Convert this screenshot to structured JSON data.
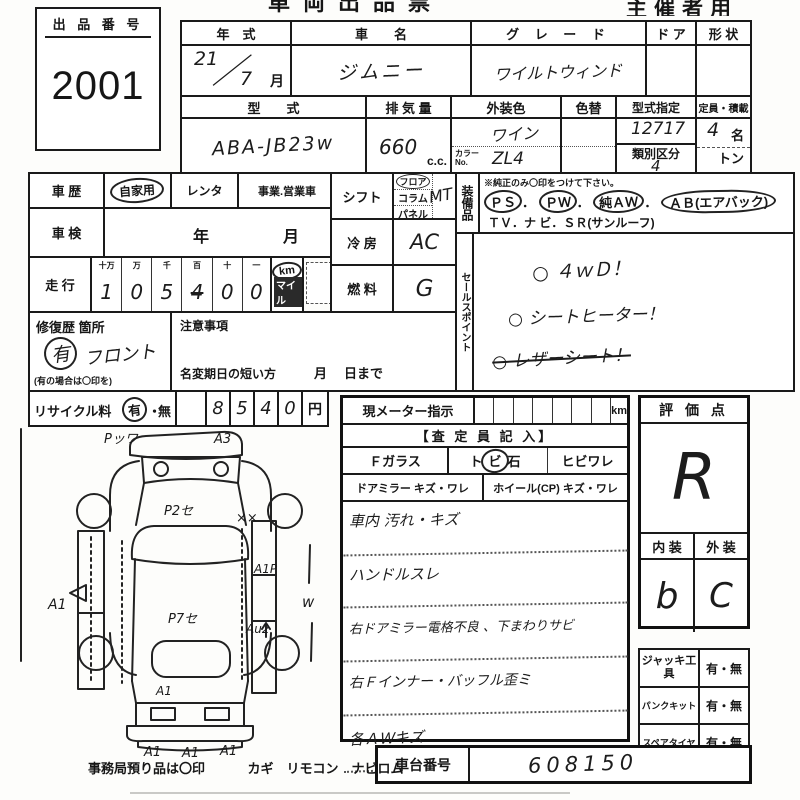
{
  "header": {
    "title_fragment": "車両出品票",
    "organizer": "主催者用"
  },
  "lot": {
    "label": "出 品 番 号",
    "number": "2001"
  },
  "top_table": {
    "year_label": "年　式",
    "year_top": "21",
    "year_slash": "／",
    "year_bottom": "7",
    "month_label": "月",
    "name_label": "車　　名",
    "name_value": "ジムニー",
    "grade_label": "グ レ ー ド",
    "grade_value": "ワイルトウィンド",
    "door_label": "ド ア",
    "shape_label": "形 状",
    "model_label": "型　　式",
    "model_value": "ABA-JB23w",
    "disp_label": "排 気 量",
    "disp_value": "660",
    "disp_unit": "c.c.",
    "extcolor_label": "外装色",
    "extcolor_value": "ワイン",
    "colorno_label": "カラーNo.",
    "colorno_value": "ZL4",
    "colorchg_label": "色替",
    "typedesig_label": "型式指定",
    "typedesig_value": "12717",
    "class_label": "類別区分",
    "class_value": "4",
    "capacity_label": "定員・積載",
    "capacity_value": "4",
    "capacity_unit": "名",
    "load_unit": "トン"
  },
  "history": {
    "label": "車 歴",
    "opt1": "自家用",
    "opt2": "レンタ",
    "opt3": "事業.営業車"
  },
  "shaken": {
    "label": "車 検",
    "year": "年",
    "month": "月"
  },
  "mileage": {
    "label": "走 行",
    "headers": [
      "十万",
      "万",
      "千",
      "百",
      "十",
      "一"
    ],
    "digits": [
      "1",
      "0",
      "5",
      "4",
      "0",
      "0"
    ],
    "km": "km",
    "mile": "マイル"
  },
  "repair": {
    "label": "修復歴 箇所",
    "mark": "有",
    "value": "フロント",
    "note": "(有の場合は〇印を)"
  },
  "caution": {
    "label": "注意事項",
    "transfer": "名変期日の短い方",
    "m": "月",
    "d": "日まで"
  },
  "recycle": {
    "label": "リサイクル料",
    "yes": "有",
    "sep": "・",
    "no": "無",
    "digits": [
      "8",
      "5",
      "4",
      "0"
    ],
    "unit": "円"
  },
  "shift": {
    "label": "シフト",
    "opt1": "フロア",
    "opt2": "コラム",
    "opt3": "パネル",
    "value": "MT"
  },
  "cooling": {
    "label": "冷 房",
    "value": "AC"
  },
  "fuel": {
    "label": "燃 料",
    "value": "G"
  },
  "equipment": {
    "label": "装備品",
    "note": "※純正のみ〇印をつけて下さい。",
    "ps": "ＰＳ",
    "pw": "ＰＷ",
    "aw": "純ＡＷ",
    "ab": "ＡＢ(エアバック)",
    "sep": "．",
    "line2": "ＴＶ．ナ ビ．ＳＲ(サンルーフ)",
    "line3": "新車保証書←(注) 後日送りのみ"
  },
  "sales": {
    "label": "セールスポイント",
    "item1": "○ ４ｗＤ！",
    "item2": "○ シートヒーター！",
    "item3": "○ レザーシート！"
  },
  "meter": {
    "label": "現メーター指示",
    "unit": "km",
    "assessor": "【査 定 員 記 入】",
    "fglass": "Ｆガラス",
    "stone": "トビ石",
    "crack": "ヒビワレ",
    "mirror": "ドアミラー キズ・ワレ",
    "wheel": "ホイール(CP) キズ・ワレ",
    "notes": [
      "車内 汚れ・キズ",
      "ハンドルスレ",
      "右ドアミラー電格不良 、下まわりサビ",
      "右Ｆインナー・バッフル歪ミ",
      "各ＡＷキズ"
    ]
  },
  "evaluation": {
    "label": "評 価 点",
    "score": "R",
    "interior_label": "内 装",
    "interior": "b",
    "exterior_label": "外 装",
    "exterior": "C"
  },
  "tools": {
    "jack": "ジャッキ工具",
    "pank": "パンクキット",
    "spare": "スペアタイヤ",
    "option": "有・無"
  },
  "chassis": {
    "label": "車台番号",
    "value": "608150"
  },
  "diagram": {
    "top_left": "Pッワ",
    "top_right": "A3",
    "hood": "P2セ",
    "xx": "××",
    "roof": "P7セ",
    "a1p": "A1P",
    "left_a1": "A1",
    "au2": "Au2",
    "w": "w",
    "tail_a1": "A1",
    "rear_a1a": "A1",
    "rear_a1b": "A1",
    "rear_a1c": "A1"
  },
  "footer": {
    "note": "事務局預り品は〇印",
    "items": "カギ　リモコン　ナビロム"
  }
}
